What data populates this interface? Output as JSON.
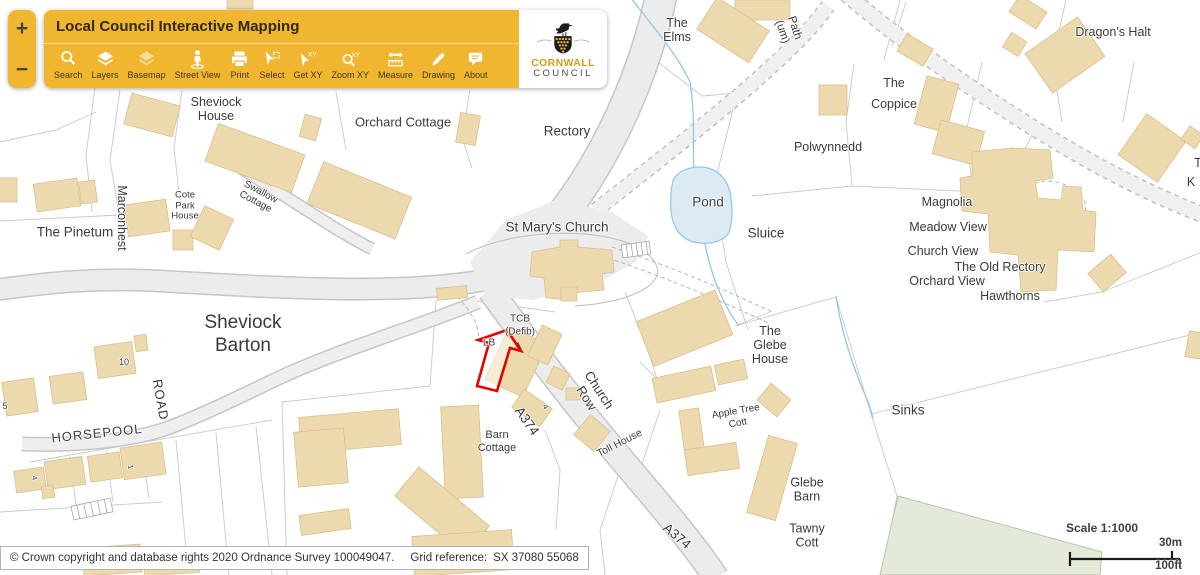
{
  "zoom_controls": {
    "in": "+",
    "out": "−"
  },
  "toolbar": {
    "title": "Local Council Interactive Mapping",
    "tools": [
      {
        "label": "Search",
        "icon": "search-icon"
      },
      {
        "label": "Layers",
        "icon": "layers-icon"
      },
      {
        "label": "Basemap",
        "icon": "basemap-icon"
      },
      {
        "label": "Street View",
        "icon": "street-view-icon"
      },
      {
        "label": "Print",
        "icon": "print-icon"
      },
      {
        "label": "Select",
        "icon": "select-icon"
      },
      {
        "label": "Get XY",
        "icon": "get-xy-icon"
      },
      {
        "label": "Zoom XY",
        "icon": "zoom-xy-icon"
      },
      {
        "label": "Measure",
        "icon": "measure-icon"
      },
      {
        "label": "Drawing",
        "icon": "drawing-icon"
      },
      {
        "label": "About",
        "icon": "about-icon"
      }
    ],
    "logo": {
      "line1": "CORNWALL",
      "line2": "COUNCIL"
    }
  },
  "map": {
    "scale": {
      "title": "Scale 1:1000",
      "metric": "30m",
      "imperial": "100ft"
    },
    "labels": [
      {
        "name": "the-elms",
        "lines": [
          "The",
          "Elms"
        ],
        "x": 677,
        "y": 30,
        "size": 12.5
      },
      {
        "name": "path-um",
        "lines": [
          "Path",
          "(um)"
        ],
        "x": 788,
        "y": 30,
        "size": 11.5,
        "rot": 72
      },
      {
        "name": "dragons-halt",
        "lines": [
          "Dragon's Halt"
        ],
        "x": 1113,
        "y": 32,
        "size": 12.5
      },
      {
        "name": "the-coppice",
        "lines": [
          "The",
          "Coppice"
        ],
        "x": 894,
        "y": 94,
        "size": 12.5,
        "lh": 21
      },
      {
        "name": "polwynnedd",
        "lines": [
          "Polwynnedd"
        ],
        "x": 828,
        "y": 147,
        "size": 12.5
      },
      {
        "name": "sheviock-house",
        "lines": [
          "Sheviock",
          "House"
        ],
        "x": 216,
        "y": 109,
        "size": 12.5
      },
      {
        "name": "orchard-cottage",
        "lines": [
          "Orchard Cottage"
        ],
        "x": 403,
        "y": 123,
        "size": 13
      },
      {
        "name": "rectory",
        "lines": [
          "Rectory"
        ],
        "x": 567,
        "y": 131,
        "size": 13.5
      },
      {
        "name": "pond",
        "lines": [
          "Pond"
        ],
        "x": 708,
        "y": 202,
        "size": 13.5
      },
      {
        "name": "sluice",
        "lines": [
          "Sluice"
        ],
        "x": 766,
        "y": 233,
        "size": 13.5
      },
      {
        "name": "magnolia",
        "lines": [
          "Magnolia"
        ],
        "x": 947,
        "y": 202,
        "size": 12.5
      },
      {
        "name": "meadow-view",
        "lines": [
          "Meadow View"
        ],
        "x": 948,
        "y": 227,
        "size": 12.5
      },
      {
        "name": "church-view",
        "lines": [
          "Church View"
        ],
        "x": 943,
        "y": 251,
        "size": 12.5
      },
      {
        "name": "the-old-rectory",
        "lines": [
          "The Old Rectory"
        ],
        "x": 1000,
        "y": 267,
        "size": 12.5
      },
      {
        "name": "orchard-view",
        "lines": [
          "Orchard View"
        ],
        "x": 947,
        "y": 281,
        "size": 12.5
      },
      {
        "name": "hawthorns",
        "lines": [
          "Hawthorns"
        ],
        "x": 1010,
        "y": 296,
        "size": 12.5
      },
      {
        "name": "st-marys-church",
        "lines": [
          "St Mary's Church"
        ],
        "x": 557,
        "y": 227,
        "size": 13.5
      },
      {
        "name": "the-pinetum",
        "lines": [
          "The Pinetum"
        ],
        "x": 75,
        "y": 232,
        "size": 13.5
      },
      {
        "name": "marconhest",
        "lines": [
          "Marconhest"
        ],
        "x": 122,
        "y": 218,
        "size": 12.5,
        "rot": 90
      },
      {
        "name": "cote-park-house",
        "lines": [
          "Cote",
          "Park",
          "House"
        ],
        "x": 185,
        "y": 206,
        "size": 9.5,
        "lh": 10.5
      },
      {
        "name": "swallow-cottage",
        "lines": [
          "Swallow",
          "Cottage"
        ],
        "x": 258,
        "y": 197,
        "size": 10,
        "rot": 28,
        "lh": 11
      },
      {
        "name": "sheviock-barton",
        "lines": [
          "Sheviock",
          "Barton"
        ],
        "x": 243,
        "y": 334,
        "size": 19,
        "lh": 23
      },
      {
        "name": "horsepool",
        "lines": [
          "HORSEPOOL"
        ],
        "x": 97,
        "y": 434,
        "size": 13,
        "rot": -6,
        "ls": 1
      },
      {
        "name": "road",
        "lines": [
          "ROAD"
        ],
        "x": 160,
        "y": 400,
        "size": 13,
        "rot": 80,
        "ls": 1
      },
      {
        "name": "number-10",
        "lines": [
          "10"
        ],
        "x": 124,
        "y": 362,
        "size": 9
      },
      {
        "name": "number-5",
        "lines": [
          "5"
        ],
        "x": 5,
        "y": 406,
        "size": 9
      },
      {
        "name": "number-4-west",
        "lines": [
          "4"
        ],
        "x": 34,
        "y": 478,
        "size": 7.5,
        "rot": 75
      },
      {
        "name": "number-1",
        "lines": [
          "1"
        ],
        "x": 130,
        "y": 467,
        "size": 7.5,
        "rot": 75
      },
      {
        "name": "tcb-defib",
        "lines": [
          "TCB",
          "(Defib)"
        ],
        "x": 520,
        "y": 326,
        "size": 10,
        "lh": 12.5
      },
      {
        "name": "lb",
        "lines": [
          "LB"
        ],
        "x": 489,
        "y": 343,
        "size": 10
      },
      {
        "name": "church-row",
        "lines": [
          "Church",
          "Row"
        ],
        "x": 593,
        "y": 394,
        "size": 13,
        "rot": 57,
        "lh": 15
      },
      {
        "name": "a374-upper",
        "lines": [
          "A374"
        ],
        "x": 527,
        "y": 421,
        "size": 13.5,
        "rot": 55
      },
      {
        "name": "number-4-mid",
        "lines": [
          "4"
        ],
        "x": 545,
        "y": 407,
        "size": 7.5,
        "rot": 60
      },
      {
        "name": "barn-cottage",
        "lines": [
          "Barn",
          "Cottage"
        ],
        "x": 497,
        "y": 442,
        "size": 11,
        "lh": 13
      },
      {
        "name": "toll-house",
        "lines": [
          "Toll House"
        ],
        "x": 620,
        "y": 444,
        "size": 10.5,
        "rot": -27
      },
      {
        "name": "apple-tree-cott",
        "lines": [
          "Apple Tree",
          "Cott"
        ],
        "x": 737,
        "y": 418,
        "size": 10,
        "rot": -10,
        "lh": 12
      },
      {
        "name": "the-glebe-house",
        "lines": [
          "The",
          "Glebe",
          "House"
        ],
        "x": 770,
        "y": 345,
        "size": 12.5,
        "lh": 14
      },
      {
        "name": "sinks",
        "lines": [
          "Sinks"
        ],
        "x": 908,
        "y": 410,
        "size": 13.5
      },
      {
        "name": "glebe-barn",
        "lines": [
          "Glebe",
          "Barn"
        ],
        "x": 807,
        "y": 490,
        "size": 12.5,
        "lh": 13.5
      },
      {
        "name": "tawny-cott",
        "lines": [
          "Tawny",
          "Cott"
        ],
        "x": 807,
        "y": 536,
        "size": 12.5,
        "lh": 13.5
      },
      {
        "name": "a374-lower",
        "lines": [
          "A374"
        ],
        "x": 677,
        "y": 536,
        "size": 13.5,
        "rot": 40
      },
      {
        "name": "label-k-cut",
        "lines": [
          "K"
        ],
        "x": 1191,
        "y": 182,
        "size": 12.5
      },
      {
        "name": "label-t-cut",
        "lines": [
          "T"
        ],
        "x": 1198,
        "y": 163,
        "size": 12.5
      }
    ]
  },
  "footer": {
    "copyright": "© Crown copyright and database rights 2020 Ordnance Survey 100049047.",
    "grid_ref_label": "Grid reference:",
    "grid_ref_value": "SX 37080 55068"
  },
  "colors": {
    "toolbar_amber": "#f0b62f",
    "building_fill": "#ecdaae",
    "road_fill": "#ececec",
    "pond_fill": "#dcebf3",
    "stream": "#8fc8e8",
    "green_field": "#e3ead9",
    "annotation_red": "#e60000",
    "label_text": "#3b3b3b"
  }
}
